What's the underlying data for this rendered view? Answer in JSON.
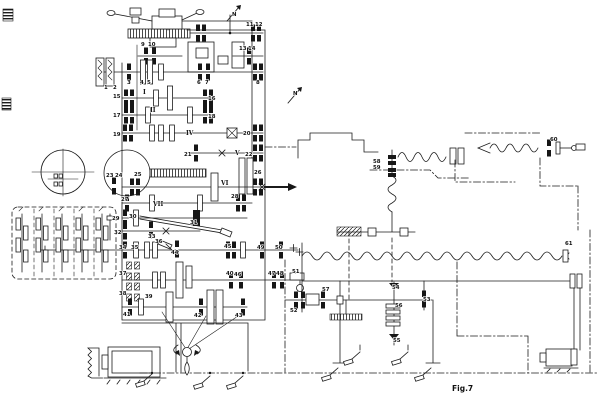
{
  "figure": {
    "caption": "Fig.7"
  },
  "colors": {
    "ink": "#1b1b1b",
    "paper": "#ffffff"
  },
  "part_labels": [
    {
      "n": "1",
      "x": 104,
      "y": 89
    },
    {
      "n": "2",
      "x": 113,
      "y": 89
    },
    {
      "n": "3",
      "x": 127,
      "y": 84
    },
    {
      "n": "4",
      "x": 140,
      "y": 84
    },
    {
      "n": "5",
      "x": 147,
      "y": 84
    },
    {
      "n": "6",
      "x": 197,
      "y": 84
    },
    {
      "n": "7",
      "x": 205,
      "y": 84
    },
    {
      "n": "8",
      "x": 256,
      "y": 84
    },
    {
      "n": "9",
      "x": 141,
      "y": 46
    },
    {
      "n": "10",
      "x": 148,
      "y": 46
    },
    {
      "n": "11",
      "x": 246,
      "y": 26
    },
    {
      "n": "12",
      "x": 255,
      "y": 26
    },
    {
      "n": "13",
      "x": 239,
      "y": 50
    },
    {
      "n": "14",
      "x": 248,
      "y": 50
    },
    {
      "n": "15",
      "x": 113,
      "y": 98
    },
    {
      "n": "16",
      "x": 208,
      "y": 100
    },
    {
      "n": "17",
      "x": 113,
      "y": 117
    },
    {
      "n": "18",
      "x": 208,
      "y": 118
    },
    {
      "n": "19",
      "x": 113,
      "y": 136
    },
    {
      "n": "20",
      "x": 243,
      "y": 135
    },
    {
      "n": "21",
      "x": 184,
      "y": 156
    },
    {
      "n": "22",
      "x": 245,
      "y": 156
    },
    {
      "n": "23",
      "x": 106,
      "y": 177
    },
    {
      "n": "24",
      "x": 115,
      "y": 177
    },
    {
      "n": "25",
      "x": 134,
      "y": 176
    },
    {
      "n": "26",
      "x": 254,
      "y": 174
    },
    {
      "n": "27",
      "x": 121,
      "y": 201
    },
    {
      "n": "28",
      "x": 231,
      "y": 198
    },
    {
      "n": "29",
      "x": 112,
      "y": 220
    },
    {
      "n": "30",
      "x": 129,
      "y": 218
    },
    {
      "n": "31",
      "x": 190,
      "y": 224
    },
    {
      "n": "32",
      "x": 114,
      "y": 234
    },
    {
      "n": "33",
      "x": 148,
      "y": 238
    },
    {
      "n": "34",
      "x": 119,
      "y": 249
    },
    {
      "n": "35",
      "x": 131,
      "y": 249
    },
    {
      "n": "36",
      "x": 155,
      "y": 243
    },
    {
      "n": "37",
      "x": 119,
      "y": 275
    },
    {
      "n": "38",
      "x": 119,
      "y": 295
    },
    {
      "n": "39",
      "x": 145,
      "y": 298
    },
    {
      "n": "40",
      "x": 226,
      "y": 275
    },
    {
      "n": "41",
      "x": 123,
      "y": 316
    },
    {
      "n": "42",
      "x": 194,
      "y": 317
    },
    {
      "n": "43",
      "x": 235,
      "y": 317
    },
    {
      "n": "44",
      "x": 171,
      "y": 254
    },
    {
      "n": "45",
      "x": 224,
      "y": 248
    },
    {
      "n": "46",
      "x": 234,
      "y": 276
    },
    {
      "n": "47",
      "x": 268,
      "y": 275
    },
    {
      "n": "48",
      "x": 276,
      "y": 275
    },
    {
      "n": "49",
      "x": 257,
      "y": 249
    },
    {
      "n": "50",
      "x": 275,
      "y": 249
    },
    {
      "n": "51",
      "x": 292,
      "y": 273
    },
    {
      "n": "52",
      "x": 290,
      "y": 312
    },
    {
      "n": "53",
      "x": 423,
      "y": 301
    },
    {
      "n": "54",
      "x": 392,
      "y": 289
    },
    {
      "n": "55",
      "x": 393,
      "y": 342
    },
    {
      "n": "56",
      "x": 395,
      "y": 307
    },
    {
      "n": "57",
      "x": 322,
      "y": 291
    },
    {
      "n": "58",
      "x": 373,
      "y": 163
    },
    {
      "n": "59",
      "x": 373,
      "y": 169
    },
    {
      "n": "60",
      "x": 550,
      "y": 141
    },
    {
      "n": "61",
      "x": 565,
      "y": 245
    }
  ],
  "shaft_labels": [
    {
      "n": "I",
      "x": 143,
      "y": 94
    },
    {
      "n": "II",
      "x": 150,
      "y": 112
    },
    {
      "n": "IV",
      "x": 186,
      "y": 135
    },
    {
      "n": "V",
      "x": 235,
      "y": 155
    },
    {
      "n": "VI",
      "x": 221,
      "y": 185
    },
    {
      "n": "VII",
      "x": 153,
      "y": 206
    }
  ],
  "motor_labels": [
    {
      "n": "N",
      "x": 232,
      "y": 16
    },
    {
      "n": "N",
      "x": 293,
      "y": 95
    }
  ]
}
